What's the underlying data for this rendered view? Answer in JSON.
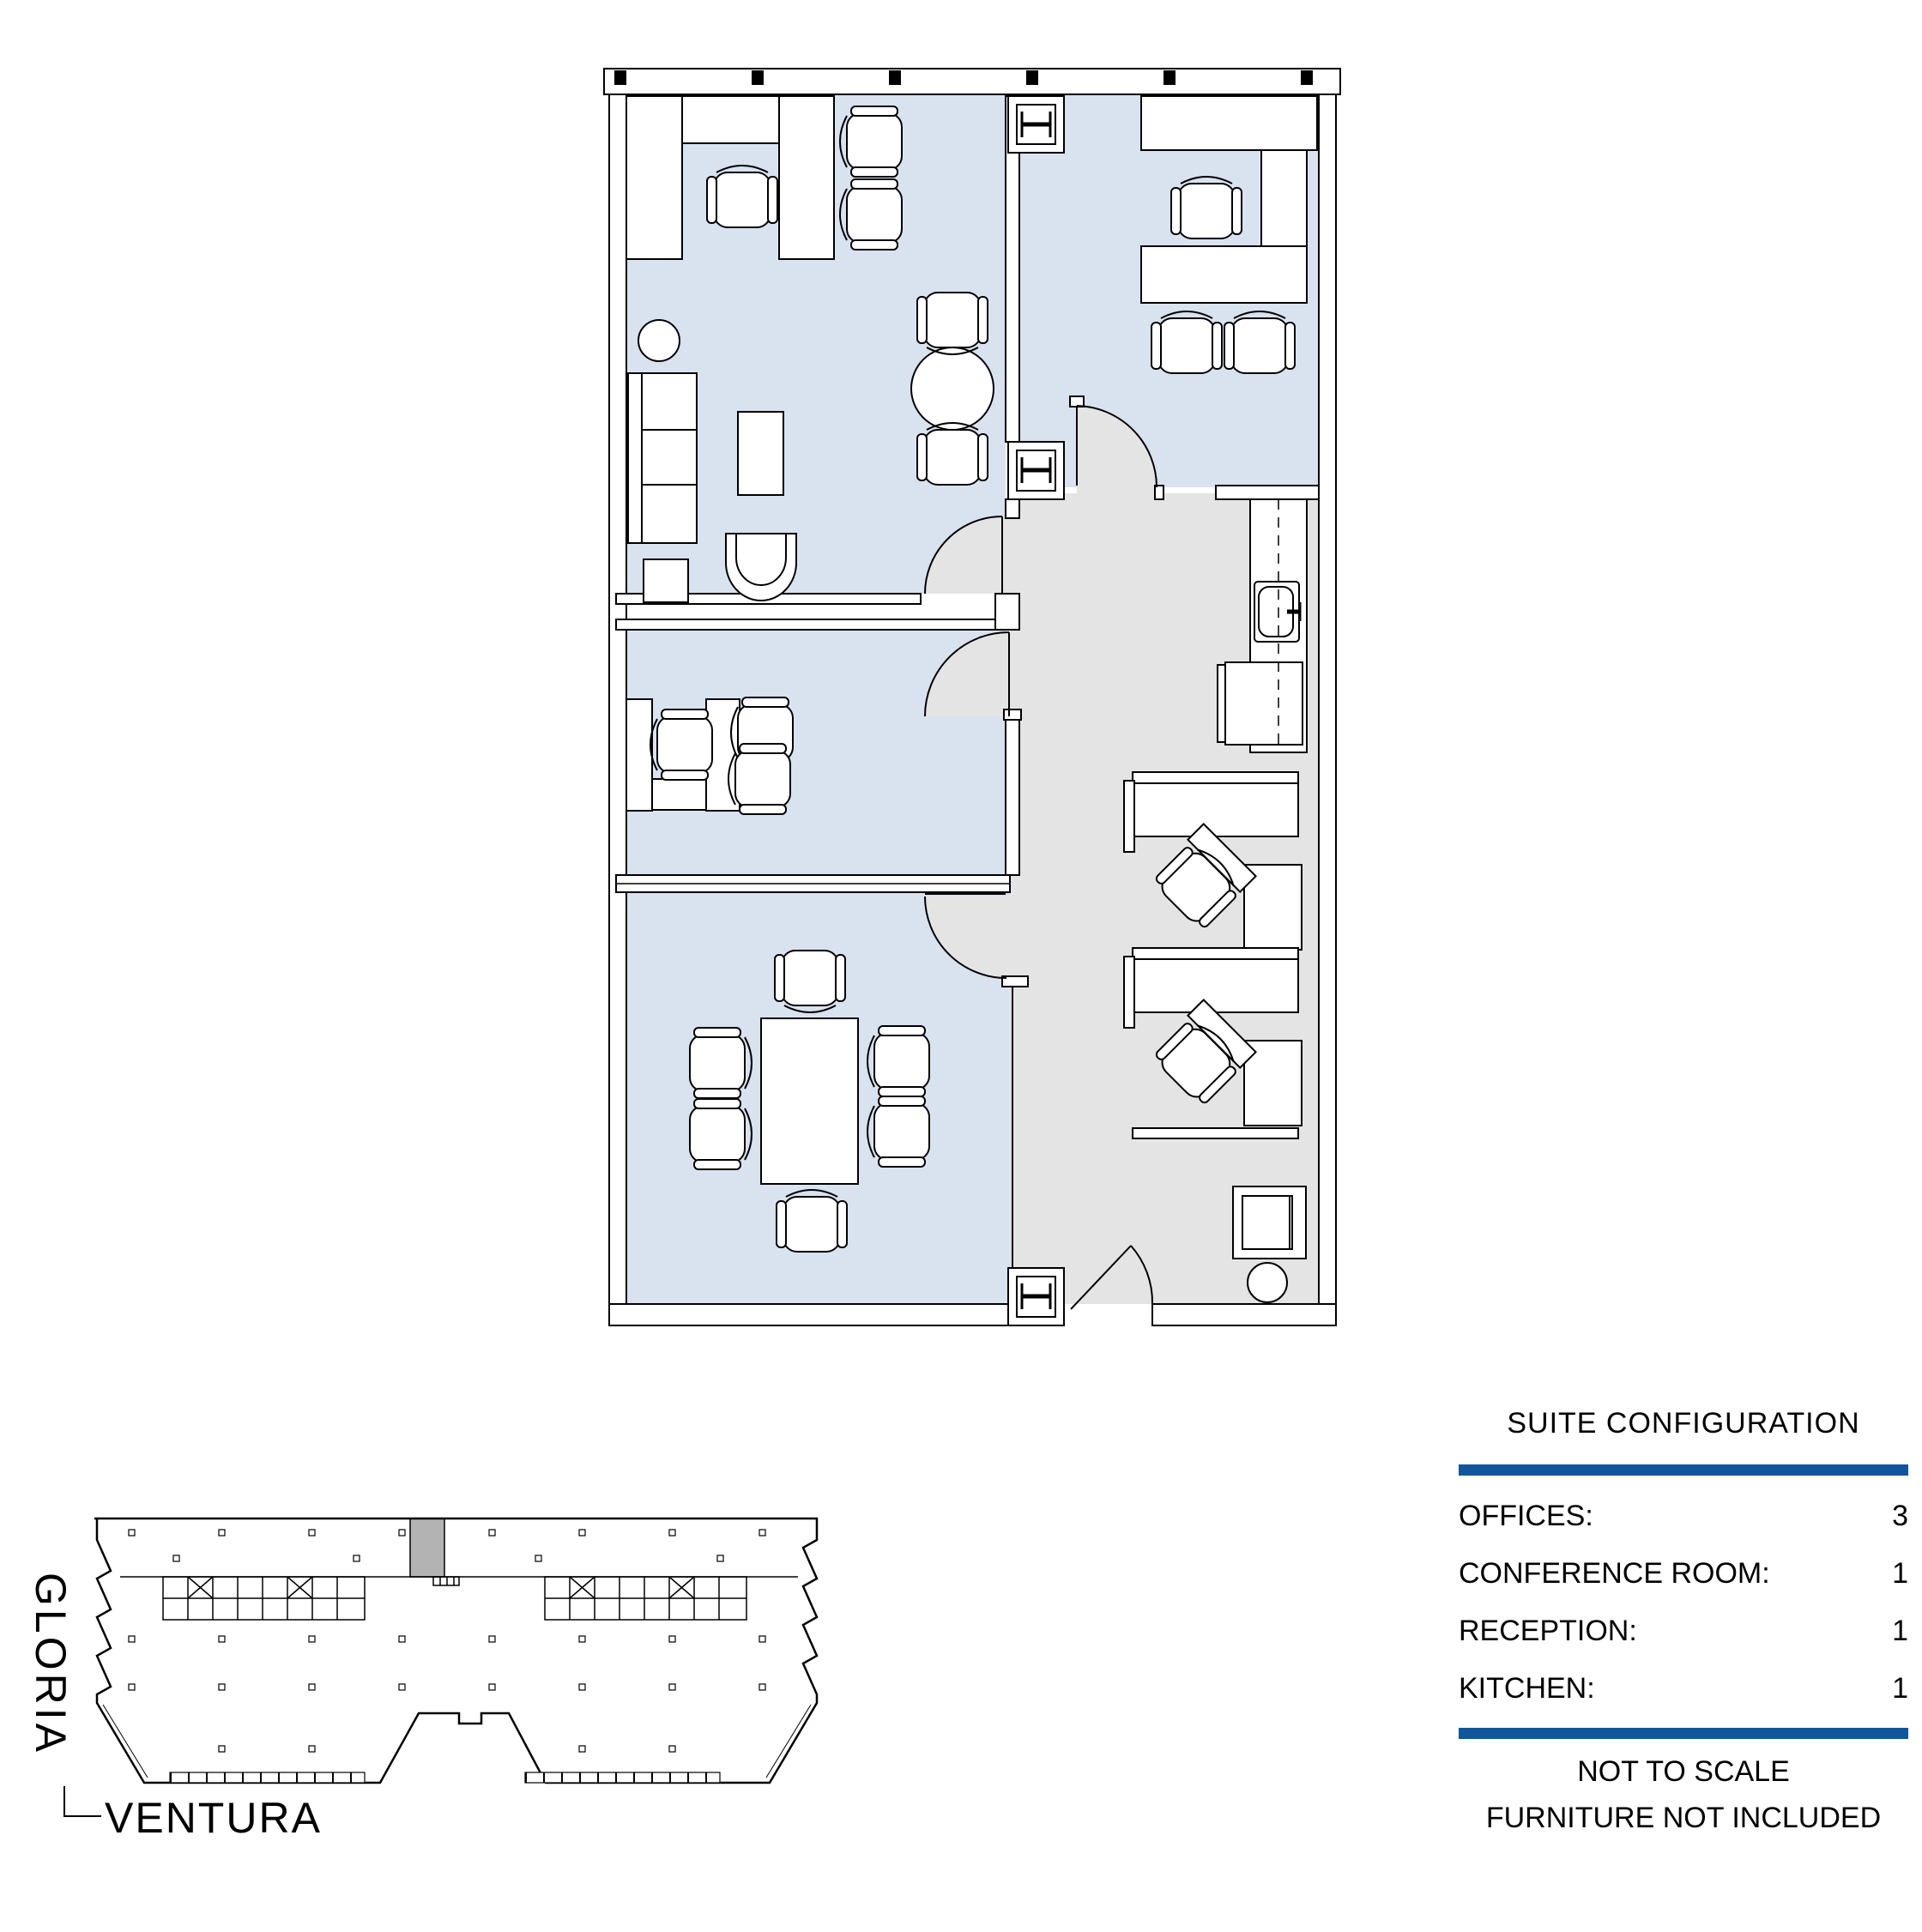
{
  "legend": {
    "title": "SUITE CONFIGURATION",
    "rows": [
      {
        "label": "OFFICES:",
        "value": "3"
      },
      {
        "label": "CONFERENCE ROOM:",
        "value": "1"
      },
      {
        "label": "RECEPTION:",
        "value": "1"
      },
      {
        "label": "KITCHEN:",
        "value": "1"
      }
    ],
    "notes": [
      "NOT TO SCALE",
      "FURNITURE NOT INCLUDED"
    ]
  },
  "key_plan": {
    "street_left": "GLORIA",
    "street_bottom": "VENTURA"
  },
  "colors": {
    "accent_blue": "#11569B",
    "room_fill": "#D9E2EF",
    "circulation_fill": "#E4E4E4",
    "suite_highlight": "#B3B3B3",
    "line": "#000000"
  }
}
